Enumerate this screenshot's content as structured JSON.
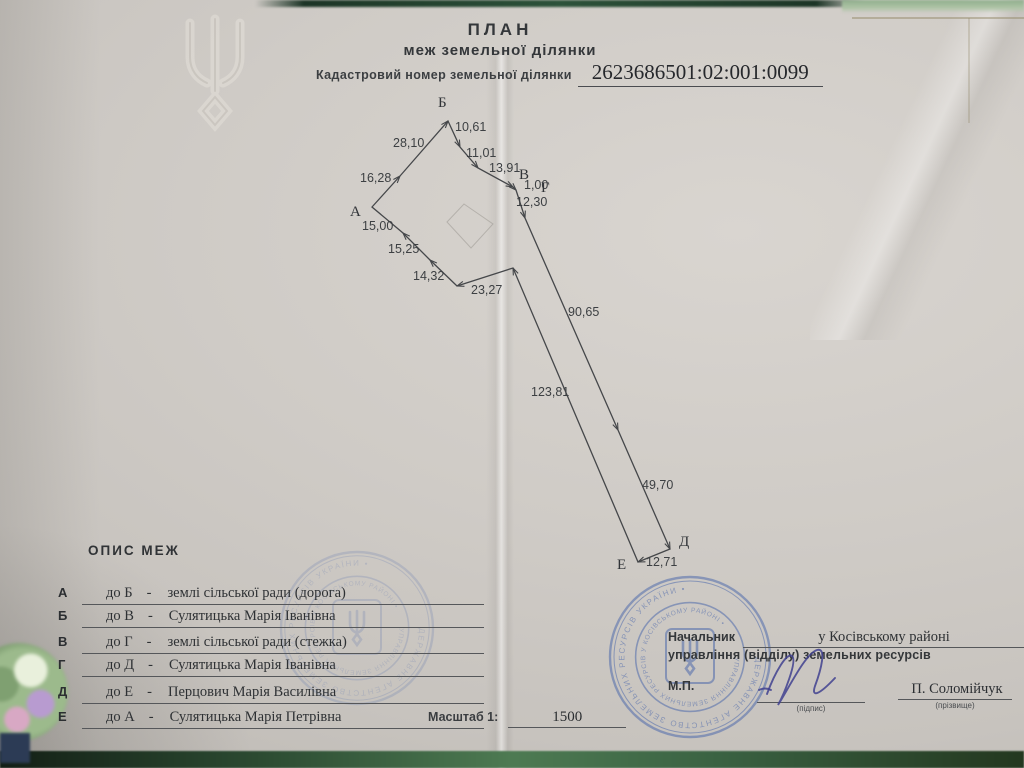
{
  "header": {
    "title": "ПЛАН",
    "subtitle": "меж земельної ділянки",
    "cadastral_label": "Кадастровий номер земельної ділянки",
    "cadastral_number": "2623686501:02:001:0099"
  },
  "diagram": {
    "border_points": [
      [
        372,
        207
      ],
      [
        400,
        176
      ],
      [
        448,
        121
      ],
      [
        460,
        147
      ],
      [
        478,
        168
      ],
      [
        513,
        187
      ],
      [
        516,
        190
      ],
      [
        525,
        218
      ],
      [
        618,
        430
      ],
      [
        670,
        549
      ],
      [
        638,
        562
      ],
      [
        513,
        268
      ],
      [
        457,
        286
      ],
      [
        430,
        260
      ],
      [
        403,
        233
      ]
    ],
    "vertex_labels": [
      {
        "t": "А",
        "x": 350,
        "y": 216
      },
      {
        "t": "Б",
        "x": 438,
        "y": 107
      },
      {
        "t": "В",
        "x": 519,
        "y": 179
      },
      {
        "t": "Г",
        "x": 541,
        "y": 192
      },
      {
        "t": "Д",
        "x": 679,
        "y": 546
      },
      {
        "t": "Е",
        "x": 617,
        "y": 569
      }
    ],
    "segment_labels": [
      {
        "t": "16,28",
        "x": 360,
        "y": 182
      },
      {
        "t": "28,10",
        "x": 393,
        "y": 147
      },
      {
        "t": "10,61",
        "x": 455,
        "y": 131
      },
      {
        "t": "11,01",
        "x": 466,
        "y": 157
      },
      {
        "t": "13,91",
        "x": 489,
        "y": 172
      },
      {
        "t": "1,00",
        "x": 524,
        "y": 189
      },
      {
        "t": "12,30",
        "x": 516,
        "y": 206
      },
      {
        "t": "90,65",
        "x": 568,
        "y": 316
      },
      {
        "t": "49,70",
        "x": 642,
        "y": 489
      },
      {
        "t": "12,71",
        "x": 646,
        "y": 566
      },
      {
        "t": "123,81",
        "x": 531,
        "y": 396
      },
      {
        "t": "23,27",
        "x": 471,
        "y": 294
      },
      {
        "t": "14,32",
        "x": 413,
        "y": 280
      },
      {
        "t": "15,25",
        "x": 388,
        "y": 253
      },
      {
        "t": "15,00",
        "x": 362,
        "y": 230
      }
    ],
    "sketch_polygon": [
      [
        447,
        222
      ],
      [
        464,
        204
      ],
      [
        493,
        224
      ],
      [
        471,
        248
      ]
    ]
  },
  "boundaries": {
    "heading": "ОПИС МЕЖ",
    "sep": "-",
    "rows": [
      {
        "from": "А",
        "to": "до Б",
        "desc": "землі сільської ради (дорога)"
      },
      {
        "from": "Б",
        "to": "до В",
        "desc": "Сулятицька Марія Іванівна"
      },
      {
        "from": "В",
        "to": "до Г",
        "desc": "землі сільської ради (стежка)"
      },
      {
        "from": "Г",
        "to": "до Д",
        "desc": "Сулятицька Марія Іванівна"
      },
      {
        "from": "Д",
        "to": "до Е",
        "desc": "Перцович Марія Василівна"
      },
      {
        "from": "Е",
        "to": "до А",
        "desc": "Сулятицька Марія Петрівна"
      }
    ]
  },
  "scale": {
    "label": "Масштаб 1:",
    "value": "1500"
  },
  "officials": {
    "title_label": "Начальник",
    "title_value": "у Косівському районі",
    "dept_line": "управління (відділу) земельних ресурсів",
    "seal_label": "М.П.",
    "signature_caption": "(підпис)",
    "name": "П. Соломійчук",
    "name_caption": "(прізвище)"
  },
  "stamp": {
    "color": "#4462aa",
    "ring_text_outer": "ДЕРЖАВНЕ АГЕНТСТВО ЗЕМЕЛЬНИХ РЕСУРСІВ УКРАЇНИ • ",
    "ring_text_inner": "УПРАВЛІННЯ ЗЕМЕЛЬНИХ РЕСУРСІВ У КОСІВСЬКОМУ РАЙОНІ • ",
    "instances": [
      {
        "cx": 690,
        "cy": 657,
        "r": 80,
        "opacity": 0.5
      },
      {
        "cx": 357,
        "cy": 628,
        "r": 76,
        "opacity": 0.18
      }
    ]
  }
}
